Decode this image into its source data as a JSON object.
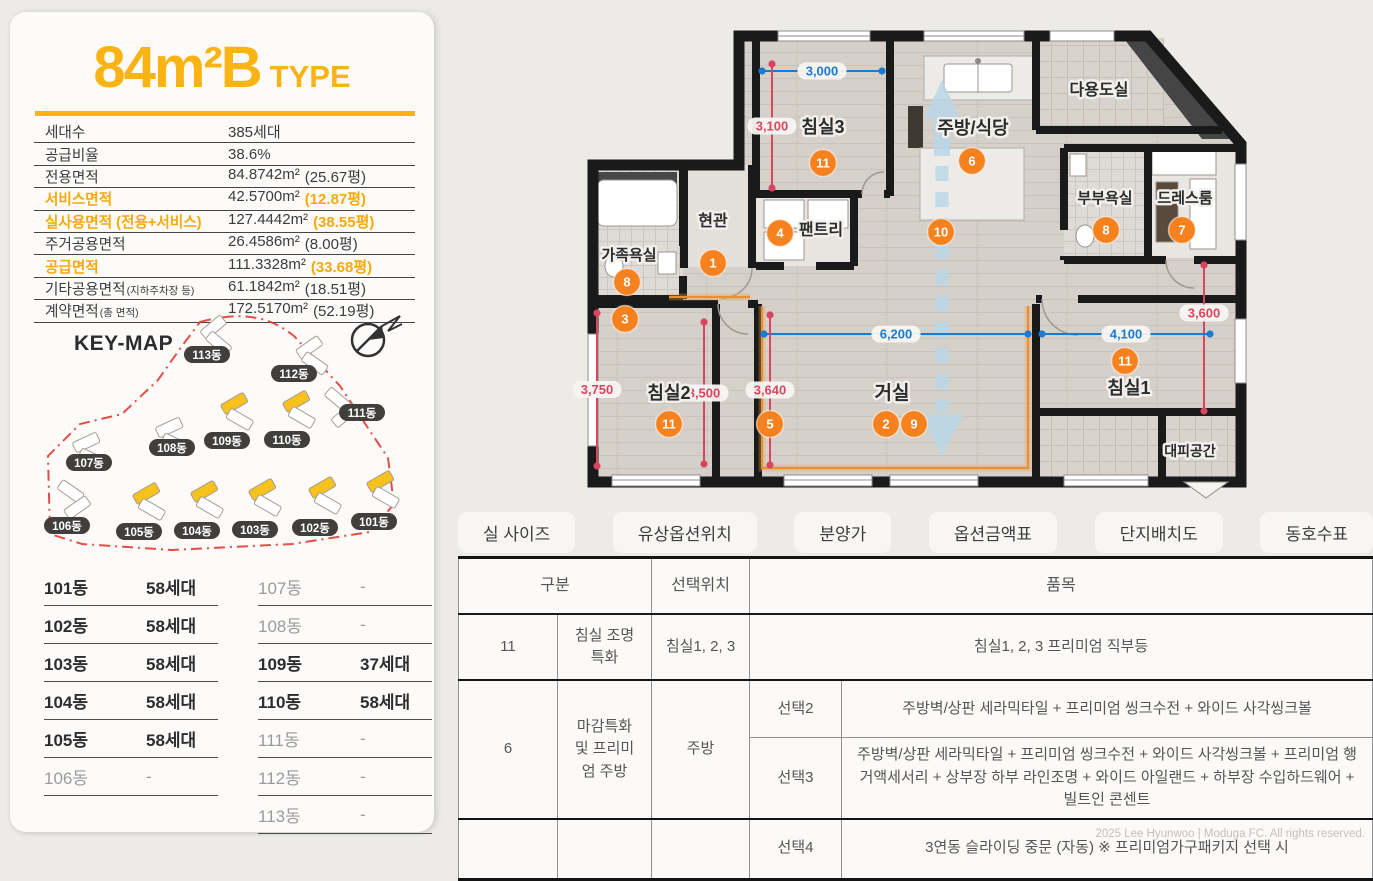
{
  "colors": {
    "accent_yellow": "#f9b414",
    "marker_orange": "#f5821f",
    "dim_blue": "#1a7cd0",
    "dim_red": "#d9455f",
    "building_yellow": "#f7c21c"
  },
  "left_panel": {
    "title": "84m²B",
    "title_suffix": "TYPE",
    "specs": [
      {
        "label": "세대수",
        "value": "385세대",
        "value_paren": "",
        "highlight": false
      },
      {
        "label": "공급비율",
        "value": "38.6%",
        "value_paren": "",
        "highlight": false
      },
      {
        "label": "전용면적",
        "value": "84.8742m²",
        "value_paren": "(25.67평)",
        "highlight": false
      },
      {
        "label": "서비스면적",
        "value": "42.5700m²",
        "value_paren": "(12.87평)",
        "highlight": true
      },
      {
        "label": "실사용면적 (전용+서비스)",
        "value": "127.4442m²",
        "value_paren": "(38.55평)",
        "highlight": true
      },
      {
        "label": "주거공용면적",
        "value": "26.4586m²",
        "value_paren": "(8.00평)",
        "highlight": false
      },
      {
        "label": "공급면적",
        "value": "111.3328m²",
        "value_paren": "(33.68평)",
        "highlight": true
      },
      {
        "label": "기타공용면적",
        "label_suffix": "(지하주차장 등)",
        "value": "61.1842m²",
        "value_paren": "(18.51평)",
        "highlight": false
      },
      {
        "label": "계약면적",
        "label_suffix": "(총 면적)",
        "value": "172.5170m²",
        "value_paren": "(52.19평)",
        "highlight": false
      }
    ],
    "keymap": {
      "title": "KEY-MAP",
      "compass_icon": "compass-north-icon",
      "buildings": [
        {
          "name": "113동",
          "px": 185,
          "py": 47,
          "bx": 178,
          "by": 14,
          "rot": -40,
          "type": "white"
        },
        {
          "name": "112동",
          "px": 272,
          "py": 66,
          "bx": 274,
          "by": 34,
          "rot": -35,
          "type": "white"
        },
        {
          "name": "111동",
          "px": 340,
          "py": 105,
          "bx": 303,
          "by": 86,
          "rot": 40,
          "type": "white"
        },
        {
          "name": "109동",
          "px": 205,
          "py": 133,
          "bx": 199,
          "by": 90,
          "rot": -30,
          "type": "yellow"
        },
        {
          "name": "110동",
          "px": 265,
          "py": 132,
          "bx": 261,
          "by": 88,
          "rot": -30,
          "type": "yellow"
        },
        {
          "name": "108동",
          "px": 150,
          "py": 140,
          "bx": 134,
          "by": 114,
          "rot": -25,
          "type": "white"
        },
        {
          "name": "107동",
          "px": 67,
          "py": 155,
          "bx": 51,
          "by": 129,
          "rot": -25,
          "type": "white"
        },
        {
          "name": "106동",
          "px": 45,
          "py": 218,
          "bx": 36,
          "by": 178,
          "rot": 35,
          "type": "white"
        },
        {
          "name": "105동",
          "px": 117,
          "py": 224,
          "bx": 111,
          "by": 180,
          "rot": -30,
          "type": "yellow"
        },
        {
          "name": "104동",
          "px": 175,
          "py": 223,
          "bx": 169,
          "by": 178,
          "rot": -30,
          "type": "yellow"
        },
        {
          "name": "103동",
          "px": 233,
          "py": 222,
          "bx": 227,
          "by": 176,
          "rot": -30,
          "type": "yellow"
        },
        {
          "name": "102동",
          "px": 293,
          "py": 220,
          "bx": 287,
          "by": 174,
          "rot": -30,
          "type": "yellow"
        },
        {
          "name": "101동",
          "px": 352,
          "py": 214,
          "bx": 345,
          "by": 168,
          "rot": -30,
          "type": "yellow"
        }
      ]
    },
    "units_left": [
      {
        "dong": "101동",
        "count": "58세대",
        "strong": true
      },
      {
        "dong": "102동",
        "count": "58세대",
        "strong": true
      },
      {
        "dong": "103동",
        "count": "58세대",
        "strong": true
      },
      {
        "dong": "104동",
        "count": "58세대",
        "strong": true
      },
      {
        "dong": "105동",
        "count": "58세대",
        "strong": true
      },
      {
        "dong": "106동",
        "count": "-",
        "strong": false
      }
    ],
    "units_right": [
      {
        "dong": "107동",
        "count": "-",
        "strong": false
      },
      {
        "dong": "108동",
        "count": "-",
        "strong": false
      },
      {
        "dong": "109동",
        "count": "37세대",
        "strong": true
      },
      {
        "dong": "110동",
        "count": "58세대",
        "strong": true
      },
      {
        "dong": "111동",
        "count": "-",
        "strong": false
      },
      {
        "dong": "112동",
        "count": "-",
        "strong": false
      },
      {
        "dong": "113동",
        "count": "-",
        "strong": false
      }
    ]
  },
  "floorplan": {
    "room_labels": [
      {
        "text": "침실3",
        "x": 251,
        "y": 119,
        "size": 18
      },
      {
        "text": "주방/식당",
        "x": 401,
        "y": 120,
        "size": 18
      },
      {
        "text": "다용도실",
        "x": 527,
        "y": 81,
        "size": 16
      },
      {
        "text": "현관",
        "x": 141,
        "y": 212,
        "size": 16
      },
      {
        "text": "팬트리",
        "x": 249,
        "y": 221,
        "size": 16
      },
      {
        "text": "가족욕실",
        "x": 57,
        "y": 246,
        "size": 15
      },
      {
        "text": "부부욕실",
        "x": 533,
        "y": 189,
        "size": 15
      },
      {
        "text": "드레스룸",
        "x": 613,
        "y": 189,
        "size": 15
      },
      {
        "text": "침실2",
        "x": 97,
        "y": 385,
        "size": 18
      },
      {
        "text": "거실",
        "x": 320,
        "y": 385,
        "size": 19
      },
      {
        "text": "침실1",
        "x": 557,
        "y": 380,
        "size": 18
      },
      {
        "text": "대피공간",
        "x": 618,
        "y": 442,
        "size": 14
      }
    ],
    "markers": [
      {
        "n": "1",
        "x": 141,
        "y": 249
      },
      {
        "n": "3",
        "x": 53,
        "y": 305
      },
      {
        "n": "4",
        "x": 208,
        "y": 219
      },
      {
        "n": "8",
        "x": 55,
        "y": 268
      },
      {
        "n": "11",
        "x": 251,
        "y": 149
      },
      {
        "n": "6",
        "x": 400,
        "y": 147
      },
      {
        "n": "10",
        "x": 369,
        "y": 218
      },
      {
        "n": "8",
        "x": 534,
        "y": 216
      },
      {
        "n": "7",
        "x": 610,
        "y": 216
      },
      {
        "n": "11",
        "x": 97,
        "y": 410
      },
      {
        "n": "5",
        "x": 198,
        "y": 410
      },
      {
        "n": "2",
        "x": 314,
        "y": 410
      },
      {
        "n": "9",
        "x": 342,
        "y": 410
      },
      {
        "n": "11",
        "x": 553,
        "y": 347
      }
    ],
    "dims": [
      {
        "text": "3,000",
        "x1": 190,
        "y1": 57,
        "x2": 310,
        "y2": 57,
        "color": "blue"
      },
      {
        "text": "3,100",
        "x1": 200,
        "y1": 50,
        "x2": 200,
        "y2": 174,
        "color": "red"
      },
      {
        "text": "3,600",
        "x1": 632,
        "y1": 251,
        "x2": 632,
        "y2": 397,
        "color": "red",
        "ly": 299
      },
      {
        "text": "6,200",
        "x1": 192,
        "y1": 320,
        "x2": 456,
        "y2": 320,
        "color": "blue"
      },
      {
        "text": "4,100",
        "x1": 470,
        "y1": 320,
        "x2": 638,
        "y2": 320,
        "color": "blue"
      },
      {
        "text": "3,750",
        "x1": 25,
        "y1": 299,
        "x2": 25,
        "y2": 452,
        "color": "red"
      },
      {
        "text": "3,500",
        "x1": 132,
        "y1": 308,
        "x2": 132,
        "y2": 450,
        "color": "red"
      },
      {
        "text": "3,640",
        "x1": 198,
        "y1": 301,
        "x2": 198,
        "y2": 451,
        "color": "red"
      }
    ]
  },
  "tabs": [
    {
      "name": "tab-room-size",
      "label": "실 사이즈"
    },
    {
      "name": "tab-paid-option-location",
      "label": "유상옵션위치"
    },
    {
      "name": "tab-price",
      "label": "분양가"
    },
    {
      "name": "tab-option-price-table",
      "label": "옵션금액표"
    },
    {
      "name": "tab-site-plan",
      "label": "단지배치도"
    },
    {
      "name": "tab-unit-number-table",
      "label": "동호수표"
    }
  ],
  "options_table": {
    "header": [
      {
        "text": "구분",
        "colspan": 2
      },
      {
        "text": "선택위치",
        "colspan": 1
      },
      {
        "text": "품목",
        "colspan": 2
      }
    ],
    "rows": [
      {
        "thick_top": false,
        "cells": [
          {
            "text": "11"
          },
          {
            "text": "침실 조명특화"
          },
          {
            "text": "침실1, 2, 3"
          },
          {
            "text": "침실1, 2, 3 프리미엄 직부등",
            "colspan": 2
          }
        ]
      },
      {
        "thick_top": true,
        "cells": [
          {
            "text": "6",
            "rowspan": 2
          },
          {
            "text": "마감특화 및 프리미엄 주방",
            "rowspan": 2
          },
          {
            "text": "주방",
            "rowspan": 2
          },
          {
            "text": "선택2"
          },
          {
            "text": "주방벽/상판 세라믹타일 + 프리미엄 씽크수전 + 와이드 사각씽크볼"
          }
        ]
      },
      {
        "thick_top": false,
        "cells": [
          {
            "text": "선택3"
          },
          {
            "text": "주방벽/상판 세라믹타일 + 프리미엄 씽크수전 + 와이드 사각씽크볼 + 프리미엄 행거액세서리 + 상부장 하부 라인조명 + 와이드 아일랜드 +  하부장 수입하드웨어 + 빌트인 콘센트"
          }
        ]
      },
      {
        "thick_top": true,
        "cells": [
          {
            "text": ""
          },
          {
            "text": ""
          },
          {
            "text": ""
          },
          {
            "text": "선택4"
          },
          {
            "text": "3연동 슬라이딩 중문 (자동) ※  프리미엄가구패키지 선택 시"
          }
        ]
      }
    ]
  },
  "footer": "2025 Lee Hyunwoo | Moduga FC. All rights reserved."
}
